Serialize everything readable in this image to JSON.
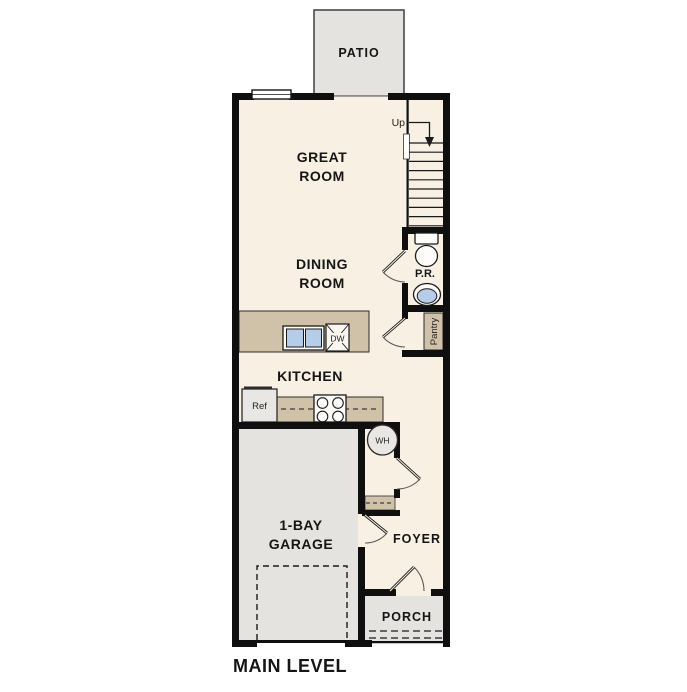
{
  "floorplan": {
    "level_title": "MAIN LEVEL",
    "rooms": {
      "patio": "PATIO",
      "great_room": {
        "line1": "GREAT",
        "line2": "ROOM"
      },
      "dining_room": {
        "line1": "DINING",
        "line2": "ROOM"
      },
      "kitchen": "KITCHEN",
      "powder_room": "P.R.",
      "pantry": "Pantry",
      "garage": {
        "line1": "1-BAY",
        "line2": "GARAGE"
      },
      "foyer": "FOYER",
      "porch": "PORCH"
    },
    "fixtures": {
      "stairs_direction": "Up",
      "dishwasher": "DW",
      "refrigerator": "Ref",
      "water_heater": "WH"
    },
    "colors": {
      "floor": "#f7f0e3",
      "exterior-surface": "#e4e3e0",
      "wall": "#0f0f0f",
      "counter": "#cfc2a8",
      "sink-water": "#b5cde9",
      "appliance": "#e8e7e4"
    }
  }
}
